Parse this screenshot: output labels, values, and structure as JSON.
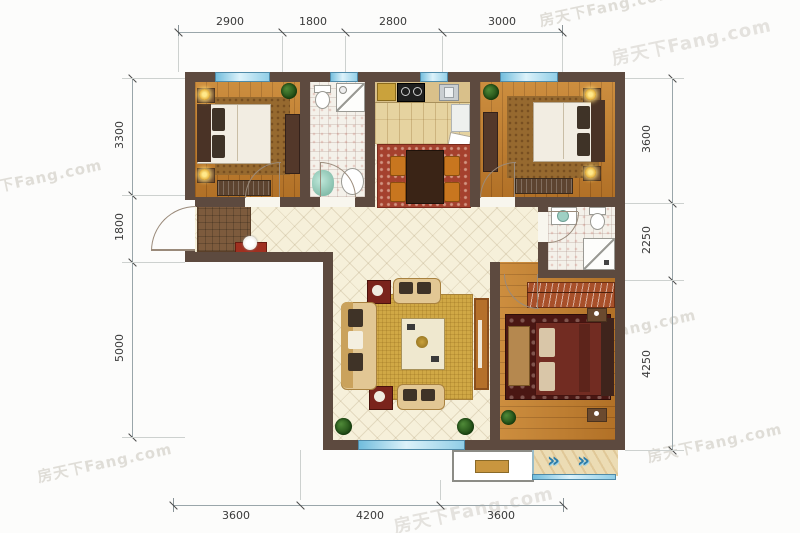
{
  "watermark": {
    "text": "房天下Fang.com"
  },
  "dimensions": {
    "top": [
      "2900",
      "1800",
      "2800",
      "3000"
    ],
    "left": [
      "3300",
      "1800",
      "5000"
    ],
    "right": [
      "3600",
      "2250",
      "4250"
    ],
    "bottom": [
      "3600",
      "4200",
      "3600"
    ]
  },
  "icons": {
    "balcony_lounge_icon": "»"
  },
  "colors": {
    "wall": "#5d4a3f",
    "wood_floor": "#c07e2e",
    "hall_tile": "#f6f0da",
    "bath_tile": "#f4f1ea",
    "kitchen_floor": "#e6d3a0",
    "window_blue": "#8fcde6",
    "dining_rug": "#a5412e",
    "living_rug": "#d0a845",
    "master_rug": "#4a1713",
    "bedroom_rug": "#96692f",
    "accent_red": "#a03020",
    "plant_green": "#2f5e24",
    "dimension_text": "#3a3a3a",
    "watermark_gray": "#c9c4bb"
  }
}
